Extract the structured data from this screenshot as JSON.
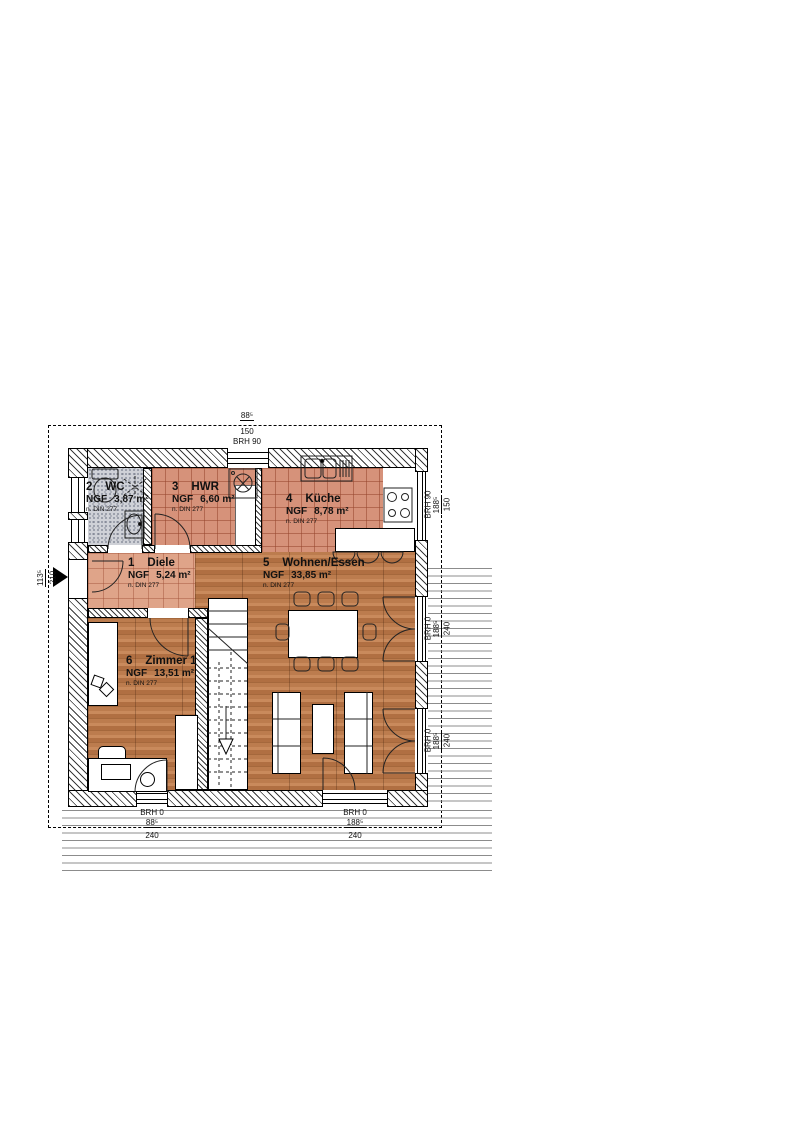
{
  "title": "Grundriss Erdgeschoss",
  "rooms": [
    {
      "num": "2",
      "name": "WC",
      "ngf_label": "NGF",
      "area": "3,87  m²",
      "din": "n. DIN 277"
    },
    {
      "num": "3",
      "name": "HWR",
      "ngf_label": "NGF",
      "area": "6,60  m²",
      "din": "n. DIN 277"
    },
    {
      "num": "4",
      "name": "Küche",
      "ngf_label": "NGF",
      "area": "8,78  m²",
      "din": "n. DIN 277"
    },
    {
      "num": "1",
      "name": "Diele",
      "ngf_label": "NGF",
      "area": "5,24  m²",
      "din": "n. DIN 277"
    },
    {
      "num": "5",
      "name": "Wohnen/Essen",
      "ngf_label": "NGF",
      "area": "33,85 m²",
      "din": "n. DIN 277"
    },
    {
      "num": "6",
      "name": "Zimmer 1",
      "ngf_label": "NGF",
      "area": "13,51 m²",
      "din": "n. DIN 277"
    }
  ],
  "dims": {
    "top": {
      "brh": "BRH 90",
      "w": "88⁵",
      "h": "150"
    },
    "entrance": {
      "w": "113⁵",
      "h": "210"
    },
    "right_kitchen": {
      "brh": "BRH 90",
      "w": "188⁵",
      "h": "150"
    },
    "right_dining": {
      "brh": "BRH 0",
      "w": "188⁵",
      "h": "240"
    },
    "right_living": {
      "brh": "BRH 0",
      "w": "188⁵",
      "h": "240"
    },
    "bottom_zimmer": {
      "brh": "BRH 0",
      "w": "88⁵",
      "h": "240"
    },
    "bottom_terrace": {
      "brh": "BRH 0",
      "w": "188⁵",
      "h": "240"
    }
  },
  "colors": {
    "wood_floor": "#b5764a",
    "tile_floor": "#d6927a",
    "tile_floor_light": "#dfa489",
    "wc_floor": "#cfd1d7",
    "deck_lines": "#8c8c8c",
    "line": "#000000"
  }
}
